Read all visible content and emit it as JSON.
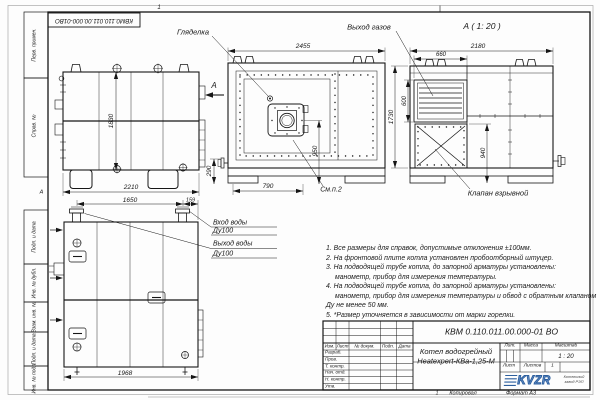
{
  "frame": {
    "stamp_number": "КВМ0.110.011.00.000-01ВО",
    "zone_top": "1",
    "zone_bottom": "1",
    "zone_letter": "А",
    "margin_cells": [
      "Перв. примен.",
      "Справ. №",
      "Подп. и дата",
      "Инв. № дубл.",
      "Взам. инв. №",
      "Подп. и дата",
      "Инв. № подл."
    ],
    "copied_label": "Копировал",
    "format_label": "Формат А3"
  },
  "views": {
    "side": {
      "section_mark": "А",
      "dim_width": "2210",
      "dim_height": "1830"
    },
    "front": {
      "callout_sight": "Гляделка",
      "callout_see": "См.п.2",
      "dim_width": "2455",
      "dim_foot": "790",
      "dim_stub": "290",
      "dim_burner": "950"
    },
    "section_a": {
      "title": "А ( 1: 20 )",
      "callout_gas": "Выход газов",
      "callout_valve": "Клапан взрывной",
      "dim_width": "2180",
      "dim_louver_w": "660",
      "dim_louver_h": "600",
      "dim_height": "1730",
      "dim_base": "940"
    },
    "rear": {
      "callout_inlet": "Вход воды",
      "callout_inlet_dn": "Ду100",
      "callout_outlet": "Выход воды",
      "callout_outlet_dn": "Ду100",
      "dim_pipes": "1650",
      "dim_edge": "159",
      "dim_width": "1968"
    }
  },
  "notes": {
    "lines": [
      "1. Все размеры для справок, допустимые отклонения ±100мм.",
      "2. На фронтовой плите котла установлен пробоотборный штуцер.",
      "3. На подводящей трубе котла, до запорной арматуры установлены:",
      "манометр, прибор для измерения температуры.",
      "4. На подводящей трубе котла, до запорной арматуры установлены:",
      "манометр, прибор для измерения температуры и обвод с обратным клапаном",
      "Ду не менее 50 мм.",
      "5. *Размер уточняется в зависимости от марки горелки."
    ]
  },
  "titleblock": {
    "doc_number": "КВМ 0.110.011.00.000-01 ВО",
    "product_name_1": "Котел водогрейный",
    "product_name_2": "Heatexpert-КВа-1,25-М",
    "col_izm": "Изм.",
    "col_list": "Лист",
    "col_doc": "№ докум.",
    "col_sign": "Подп.",
    "col_date": "Дата",
    "rows": [
      "Разраб.",
      "Пров.",
      "Т. контр.",
      "Нач. отд.",
      "Н. контр.",
      "Утв."
    ],
    "lit_label": "Лит.",
    "mass_label": "Масса",
    "scale_label": "Масштаб",
    "scale_value": "1 : 20",
    "sheet_label": "Лист",
    "sheets_label": "Листов",
    "sheets_value": "1",
    "logo_text": "KVZR",
    "logo_caption_1": "Котельный",
    "logo_caption_2": "завод РЭП"
  }
}
